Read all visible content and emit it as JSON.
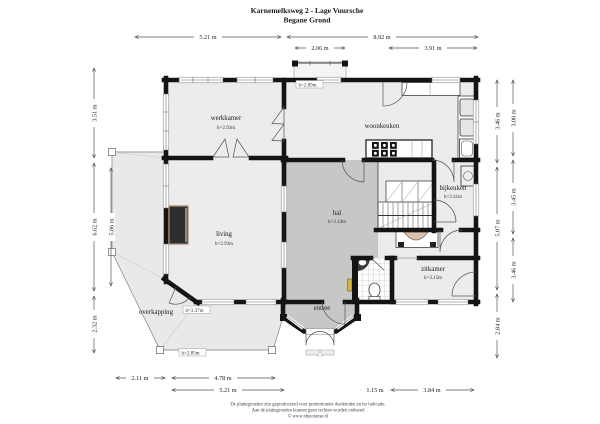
{
  "title": {
    "line1": "Karnemelksweg 2 - Lage Vuursche",
    "line2": "Begane Grond"
  },
  "rooms": {
    "werkkamer": {
      "name": "werkkamer",
      "height": "h=2.93m"
    },
    "woonkeuken": {
      "name": "woonkeuken"
    },
    "bijkeuken": {
      "name": "bijkeuken",
      "height": "h=2.41m"
    },
    "hal": {
      "name": "hal",
      "height": "h=3.14m"
    },
    "living": {
      "name": "living",
      "height": "h=2.93m"
    },
    "zitkamer": {
      "name": "zitkamer",
      "height": "h=3.15m"
    },
    "entree": {
      "name": "entree"
    },
    "overkapping": {
      "name": "overkapping",
      "height_at_wall": "h=3.37m",
      "height_at_edge": "h=2.85m"
    },
    "porch": {
      "height": "h=2.89m"
    }
  },
  "dims": {
    "top_a": "5.21 m",
    "top_b": "8.92 m",
    "top_c": "2.06 m",
    "top_d": "3.91 m",
    "left_a": "3.51 m",
    "left_b": "6.62 m",
    "left_c": "2.32 m",
    "left_inner": "5.06 m",
    "right_inner_a": "3.46 m",
    "right_inner_b": "5.07 m",
    "right_inner_c": "2.84 m",
    "right_outer_a": "3.00 m",
    "right_outer_b": "3.45 m",
    "right_outer_c": "3.46 m",
    "bottom_a": "2.11 m",
    "bottom_b": "4.78 m",
    "bottom_c": "5.21 m",
    "bottom_d": "1.15 m",
    "bottom_e": "3.84 m"
  },
  "footer": {
    "line1": "De plattegronden zijn geproduceerd voor promotionele doeleinden en ter indicatie.",
    "line2": "Aan de plattegronden kunnen geen rechten worden ontleend",
    "line3": "© www.objectense.nl"
  },
  "colors": {
    "wall": "#141414",
    "room": "#ececec",
    "hall": "#c7c7c7",
    "veranda": "#e9e9e9",
    "wood": "#a9876b",
    "radiator": "#d8b73c"
  }
}
